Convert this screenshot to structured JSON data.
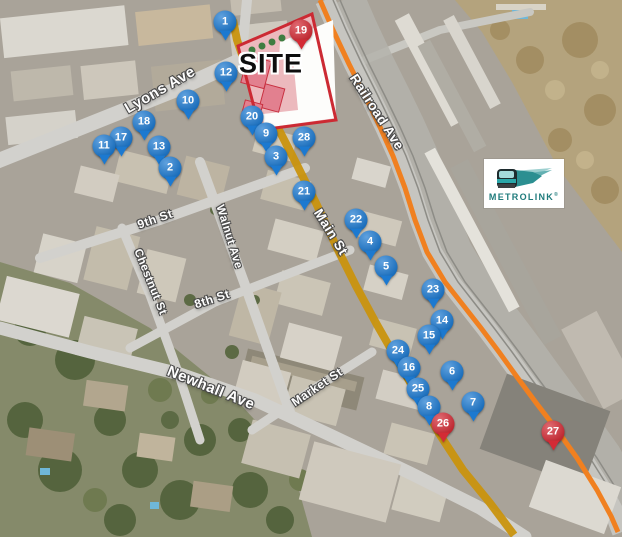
{
  "map": {
    "site_label": "SITE",
    "street_labels": [
      {
        "name": "Lyons Ave",
        "x": 160,
        "y": 90,
        "rot": -30,
        "size": 15
      },
      {
        "name": "Railroad Ave",
        "x": 377,
        "y": 112,
        "rot": 57,
        "size": 13.5
      },
      {
        "name": "Main St",
        "x": 331,
        "y": 232,
        "rot": 58,
        "size": 13.5
      },
      {
        "name": "9th St",
        "x": 155,
        "y": 219,
        "rot": -19,
        "size": 12
      },
      {
        "name": "Walnut Ave",
        "x": 229,
        "y": 237,
        "rot": 73,
        "size": 11.5
      },
      {
        "name": "Chestnut St",
        "x": 150,
        "y": 282,
        "rot": 68,
        "size": 11.5
      },
      {
        "name": "8th St",
        "x": 212,
        "y": 299,
        "rot": -18,
        "size": 12
      },
      {
        "name": "Newhall Ave",
        "x": 211,
        "y": 388,
        "rot": 22,
        "size": 15
      },
      {
        "name": "Market St",
        "x": 317,
        "y": 387,
        "rot": -34,
        "size": 12
      }
    ],
    "markers": [
      {
        "id": "1",
        "x": 225,
        "y": 22,
        "color": "blue"
      },
      {
        "id": "19",
        "x": 301,
        "y": 31,
        "color": "red"
      },
      {
        "id": "12",
        "x": 226,
        "y": 73,
        "color": "blue"
      },
      {
        "id": "10",
        "x": 188,
        "y": 101,
        "color": "blue"
      },
      {
        "id": "20",
        "x": 252,
        "y": 117,
        "color": "blue"
      },
      {
        "id": "18",
        "x": 144,
        "y": 122,
        "color": "blue"
      },
      {
        "id": "9",
        "x": 266,
        "y": 134,
        "color": "blue"
      },
      {
        "id": "28",
        "x": 304,
        "y": 138,
        "color": "blue"
      },
      {
        "id": "17",
        "x": 121,
        "y": 138,
        "color": "blue"
      },
      {
        "id": "11",
        "x": 104,
        "y": 146,
        "color": "blue"
      },
      {
        "id": "13",
        "x": 159,
        "y": 147,
        "color": "blue"
      },
      {
        "id": "3",
        "x": 276,
        "y": 157,
        "color": "blue"
      },
      {
        "id": "2",
        "x": 170,
        "y": 168,
        "color": "blue"
      },
      {
        "id": "21",
        "x": 304,
        "y": 192,
        "color": "blue"
      },
      {
        "id": "22",
        "x": 356,
        "y": 220,
        "color": "blue"
      },
      {
        "id": "4",
        "x": 370,
        "y": 242,
        "color": "blue"
      },
      {
        "id": "5",
        "x": 386,
        "y": 267,
        "color": "blue"
      },
      {
        "id": "23",
        "x": 433,
        "y": 290,
        "color": "blue"
      },
      {
        "id": "14",
        "x": 442,
        "y": 321,
        "color": "blue"
      },
      {
        "id": "15",
        "x": 429,
        "y": 336,
        "color": "blue"
      },
      {
        "id": "24",
        "x": 398,
        "y": 351,
        "color": "blue"
      },
      {
        "id": "16",
        "x": 409,
        "y": 368,
        "color": "blue"
      },
      {
        "id": "6",
        "x": 452,
        "y": 372,
        "color": "blue"
      },
      {
        "id": "25",
        "x": 418,
        "y": 389,
        "color": "blue"
      },
      {
        "id": "7",
        "x": 473,
        "y": 403,
        "color": "blue"
      },
      {
        "id": "8",
        "x": 429,
        "y": 407,
        "color": "blue"
      },
      {
        "id": "26",
        "x": 443,
        "y": 424,
        "color": "red"
      },
      {
        "id": "27",
        "x": 553,
        "y": 432,
        "color": "red"
      }
    ],
    "colors": {
      "marker_blue": "#1c79d0",
      "marker_red": "#d32b35",
      "route_orange": "#f08020",
      "route_main": "#c9940e",
      "site_outline": "#cc2a33"
    }
  },
  "logo": {
    "brand": "METROLINK",
    "registered": "®"
  }
}
